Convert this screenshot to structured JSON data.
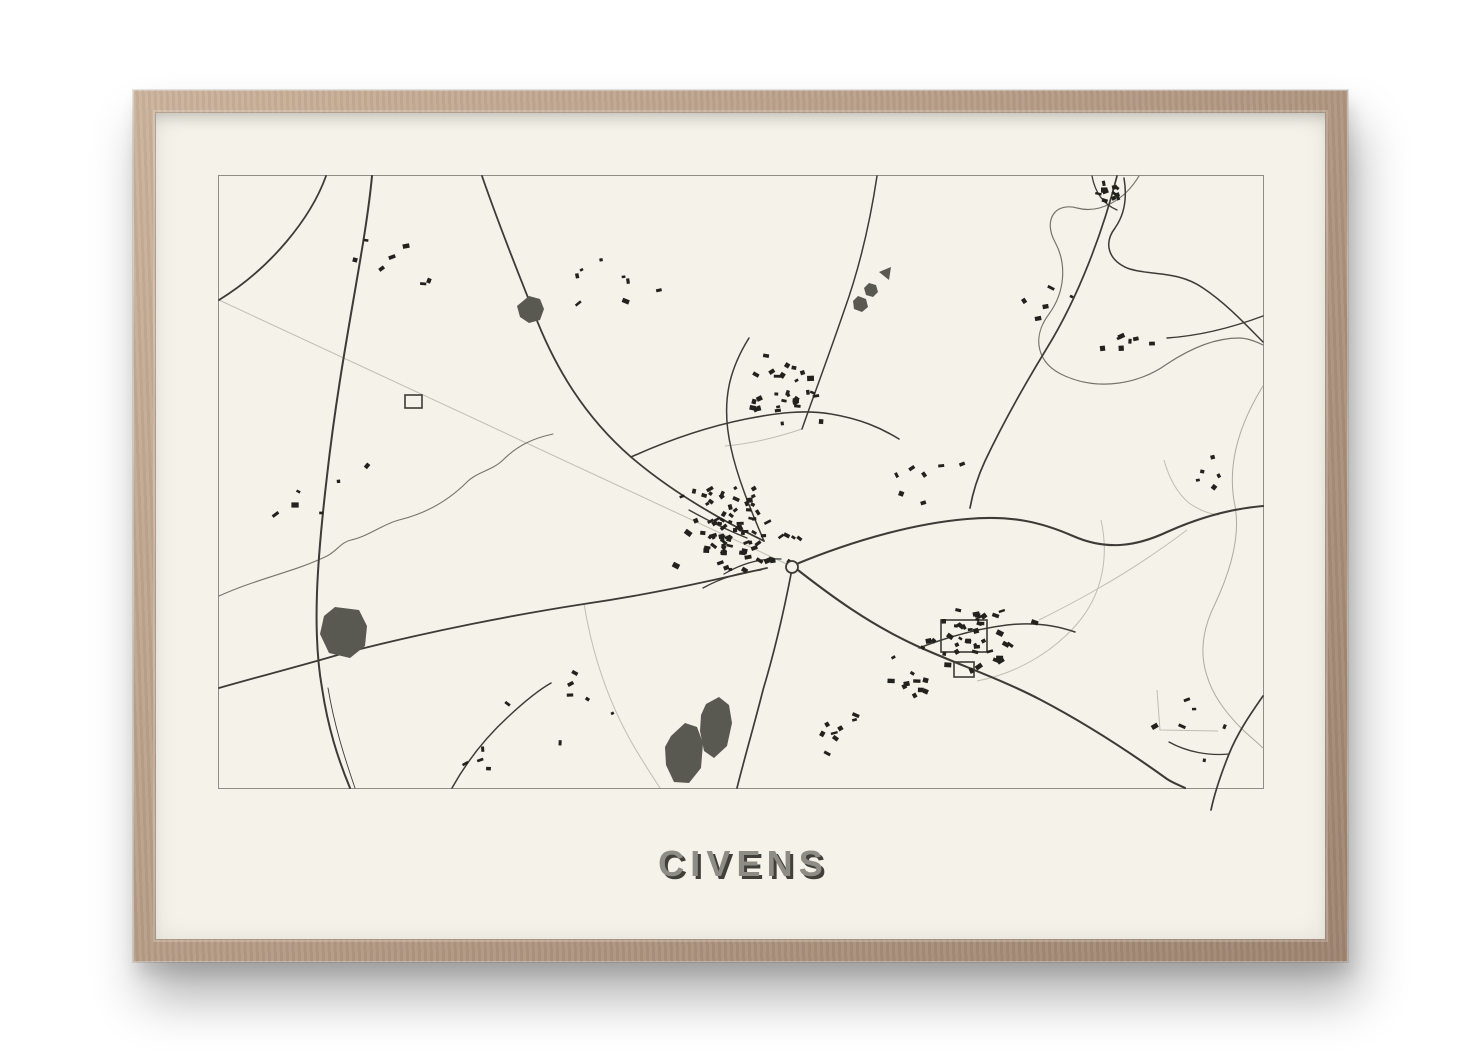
{
  "poster": {
    "title": "CIVENS"
  },
  "colors": {
    "wall": "#ffffff",
    "frame_wood": "#b69c86",
    "frame_wood_light": "#cbb29b",
    "frame_wood_dark": "#9d8470",
    "paper": "#f5f3e9",
    "map_border": "#8f8e86",
    "line": "#3c3b35",
    "river": "#75746c",
    "river_light": "#adaa9e",
    "faint": "#c0bdb1",
    "water": "#595851",
    "building": "#22211d",
    "title_fill": "#8d8c85",
    "title_shadow": "#403f3a"
  },
  "map": {
    "viewbox": "0 0 1044 612",
    "seed": 20,
    "roads": [
      {
        "d": "M107,0 C92,42 52,92 0,124",
        "w": 1.8
      },
      {
        "d": "M153,0 C146,75 122,175 108,300 C98,385 93,455 103,512 C109,552 119,583 131,612",
        "w": 2
      },
      {
        "d": "M263,0 C282,55 301,101 315,137 C336,192 366,241 412,281 C454,317 502,344 545,365",
        "w": 1.8
      },
      {
        "d": "M575,389 C640,362 700,347 748,343 C792,339 822,346 854,360 C888,375 918,370 948,356 C988,338 1020,332 1044,330",
        "w": 2.1
      },
      {
        "d": "M0,512 C42,500 85,489 122,478 C210,455 300,438 365,428 C440,417 495,404 548,392",
        "w": 1.8
      },
      {
        "d": "M898,0 C884,55 860,120 828,172 C806,208 785,245 766,285 C760,298 754,315 751,332",
        "w": 1.7
      },
      {
        "d": "M658,0 C652,40 643,85 625,135 C611,176 596,216 583,253",
        "w": 1.5
      },
      {
        "d": "M412,281 C452,263 492,250 527,243 C562,236 587,234 612,238 C642,243 662,252 680,263",
        "w": 1.6
      },
      {
        "d": "M575,391 C612,420 650,448 698,470 C740,489 782,503 822,524 C862,545 905,572 948,603 C954,607 960,609 966,612",
        "w": 2.1
      },
      {
        "d": "M700,472 C726,462 756,453 788,449 C814,446 836,449 856,456",
        "w": 1.5
      },
      {
        "d": "M573,393 C565,435 556,474 544,514 C536,546 526,580 518,612",
        "w": 1.7
      },
      {
        "d": "M545,365 C530,330 518,300 512,272 C507,250 506,230 510,210 C513,195 520,178 530,162",
        "w": 1.5
      },
      {
        "d": "M1044,520 C1030,540 1018,558 1010,578 C1002,598 996,615 992,634",
        "w": 1.7
      },
      {
        "d": "M1010,578 C990,580 968,576 950,566",
        "w": 1.3
      },
      {
        "d": "M1044,140 C1012,152 978,160 948,162",
        "w": 1.4
      },
      {
        "d": "M905,2 C908,20 906,38 896,52 C884,68 890,84 908,92 C930,100 958,94 984,112 C1008,128 1028,150 1044,166",
        "w": 1.5
      },
      {
        "d": "M873,0 C876,16 884,28 898,34",
        "w": 1.3
      },
      {
        "d": "M233,612 C248,585 268,560 290,540 C305,526 318,515 332,507",
        "w": 1.5
      },
      {
        "d": "M470,334 C488,344 508,354 528,362",
        "w": 1.3
      },
      {
        "d": "M505,398 C522,388 542,382 562,383",
        "w": 1.3
      },
      {
        "d": "M484,412 C502,402 522,396 542,394",
        "w": 1.3
      },
      {
        "d": "M109,512 C115,548 125,580 136,612",
        "w": 0.9
      }
    ],
    "rivers": [
      {
        "d": "M920,0 C905,25 880,38 858,32 C836,26 824,44 836,66 C848,88 846,116 830,138 C812,162 818,188 846,200 C880,215 920,208 948,188 C972,172 996,162 1020,162 C1028,162 1036,165 1044,169",
        "w": 1.2,
        "tone": "river"
      },
      {
        "d": "M1044,210 C1018,252 1008,292 1016,330 C1022,362 1010,398 996,428 C984,452 980,476 988,500 C994,520 1008,538 1022,552 C1030,560 1038,566 1044,572",
        "w": 1,
        "tone": "river_light"
      },
      {
        "d": "M0,420 C40,402 75,396 108,380 C118,375 122,366 132,364 C150,360 164,348 180,344 C205,338 228,326 248,306 C258,296 274,294 284,284 C300,268 316,262 334,258",
        "w": 1.1,
        "tone": "river"
      }
    ],
    "faint_paths": [
      {
        "d": "M0,124 L572,390",
        "w": 1
      },
      {
        "d": "M365,428 C372,470 385,515 408,558 C418,577 430,595 441,612",
        "w": 1
      },
      {
        "d": "M882,344 C890,380 884,418 858,448 C832,478 795,498 758,505",
        "w": 1
      },
      {
        "d": "M945,284 C950,302 958,317 970,327 C980,334 990,338 1000,339",
        "w": 1
      },
      {
        "d": "M968,354 C940,375 910,395 880,412 C856,426 836,436 820,444",
        "w": 1
      },
      {
        "d": "M938,514 L941,554 L999,555",
        "w": 1
      },
      {
        "d": "M583,253 C556,262 530,268 506,270",
        "w": 1
      }
    ],
    "ponds": [
      {
        "points": "310,120 321,123 325,133 321,144 310,147 301,141 298,130"
      },
      {
        "points": "116,431 140,434 148,450 146,470 131,482 110,477 101,458 105,440"
      },
      {
        "points": "452,560 466,547 478,551 484,567 482,592 470,607 455,606 447,589 446,571"
      },
      {
        "points": "487,528 500,521 510,529 513,547 508,570 495,582 485,575 481,555 482,539"
      },
      {
        "points": "660,96 672,91 670,104"
      },
      {
        "points": "650,107 657,109 659,116 654,121 647,119 645,112"
      },
      {
        "points": "639,120 647,123 649,131 643,136 635,133 634,125"
      }
    ],
    "field_outlines": [
      {
        "x": 722,
        "y": 444,
        "w": 46,
        "h": 32
      },
      {
        "x": 186,
        "y": 219,
        "w": 17,
        "h": 13
      },
      {
        "x": 735,
        "y": 486,
        "w": 20,
        "h": 15
      }
    ],
    "roundabout": {
      "cx": 573,
      "cy": 391,
      "r": 6
    },
    "building_clusters": [
      {
        "cx": 518,
        "cy": 352,
        "sx": 62,
        "sy": 55,
        "n": 60
      },
      {
        "cx": 502,
        "cy": 362,
        "sx": 24,
        "sy": 20,
        "n": 22
      },
      {
        "cx": 565,
        "cy": 222,
        "sx": 52,
        "sy": 38,
        "n": 30
      },
      {
        "cx": 762,
        "cy": 462,
        "sx": 55,
        "sy": 38,
        "n": 42
      },
      {
        "cx": 692,
        "cy": 504,
        "sx": 28,
        "sy": 20,
        "n": 10
      },
      {
        "cx": 893,
        "cy": 16,
        "sx": 20,
        "sy": 14,
        "n": 11
      },
      {
        "cx": 912,
        "cy": 172,
        "sx": 38,
        "sy": 28,
        "n": 7
      },
      {
        "cx": 178,
        "cy": 82,
        "sx": 55,
        "sy": 42,
        "n": 7
      },
      {
        "cx": 118,
        "cy": 298,
        "sx": 55,
        "sy": 55,
        "n": 6
      },
      {
        "cx": 388,
        "cy": 108,
        "sx": 52,
        "sy": 42,
        "n": 8
      },
      {
        "cx": 718,
        "cy": 298,
        "sx": 65,
        "sy": 48,
        "n": 7
      },
      {
        "cx": 348,
        "cy": 518,
        "sx": 75,
        "sy": 48,
        "n": 7
      },
      {
        "cx": 618,
        "cy": 558,
        "sx": 55,
        "sy": 32,
        "n": 8
      },
      {
        "cx": 975,
        "cy": 548,
        "sx": 45,
        "sy": 55,
        "n": 6
      },
      {
        "cx": 988,
        "cy": 298,
        "sx": 42,
        "sy": 42,
        "n": 5
      },
      {
        "cx": 255,
        "cy": 585,
        "sx": 28,
        "sy": 18,
        "n": 4
      },
      {
        "cx": 845,
        "cy": 120,
        "sx": 40,
        "sy": 35,
        "n": 5
      }
    ]
  }
}
